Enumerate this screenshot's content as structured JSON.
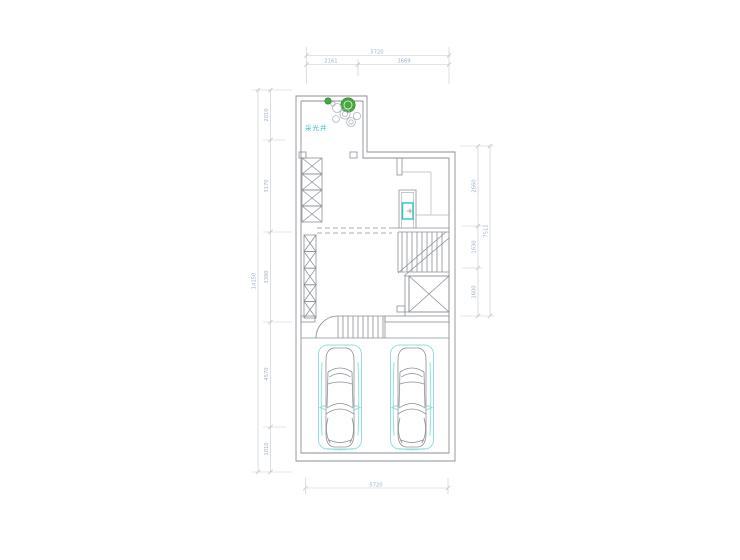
{
  "colors": {
    "wall": "#8a9096",
    "wallLight": "#b0b6bc",
    "dimLine": "#c4c9cf",
    "dimText": "#9cb0cb",
    "cyan": "#2cc5bd",
    "cyanLight": "#8fe2db",
    "green": "#46a93c",
    "greenDark": "#2f7d33"
  },
  "plan": {
    "light_well_label": "采光井",
    "dimensions": {
      "top": {
        "total": "5720",
        "segment_left": "2161",
        "segment_right": "3669"
      },
      "bottom": {
        "total": "5720"
      },
      "left": {
        "total": "14150",
        "segments": [
          "2010",
          "3170",
          "3390",
          "4570",
          "1010"
        ]
      },
      "right": {
        "total": "7511",
        "segments": [
          "2660",
          "1630",
          "1600"
        ]
      }
    }
  }
}
